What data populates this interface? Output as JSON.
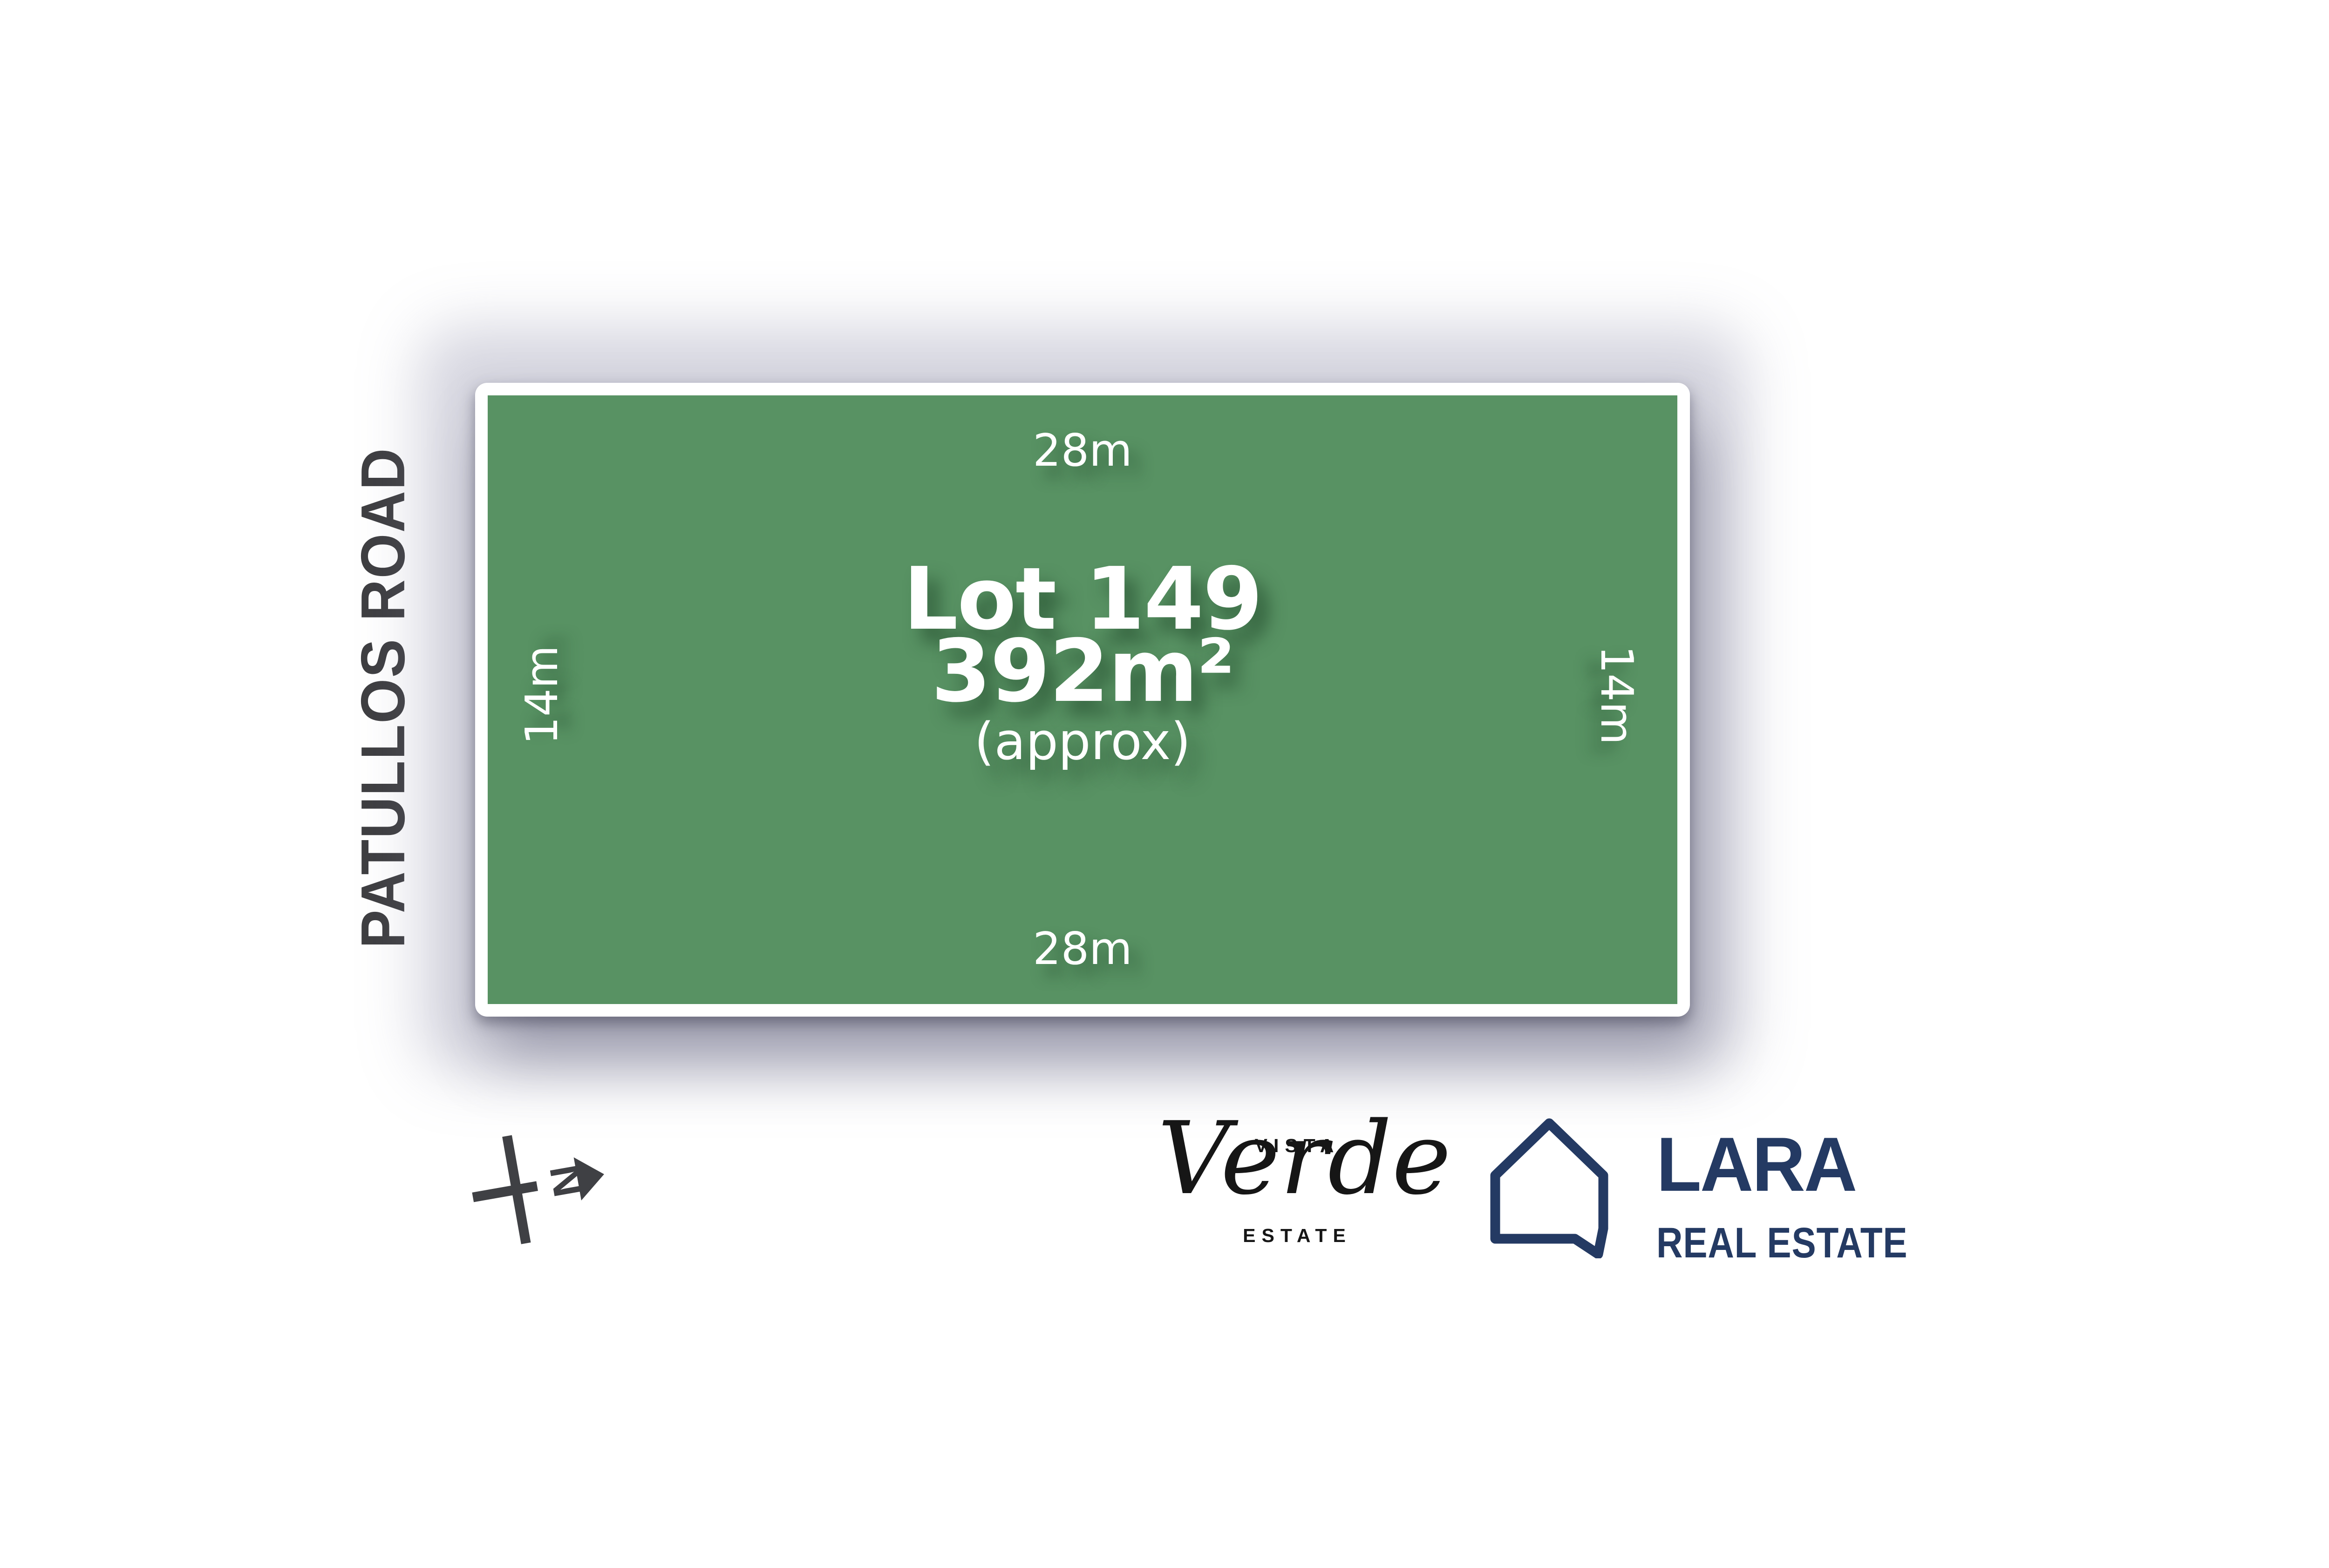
{
  "canvas": {
    "background_color": "#ffffff"
  },
  "street": {
    "label": "PATULLOS ROAD",
    "text_color": "#3e3e41"
  },
  "lot": {
    "title": "Lot 149",
    "area": "392m²",
    "area_note": "(approx)",
    "fill_color": "#589263",
    "border_color": "#ffffff",
    "text_color": "#ffffff",
    "dimensions": {
      "top": "28m",
      "right": "14m",
      "bottom": "28m",
      "left": "14m"
    }
  },
  "north_indicator": {
    "letter": "N",
    "color": "#3f4044"
  },
  "estate_logo": {
    "word_top": "VISTA",
    "word_script": "Verde",
    "word_bottom": "ESTATE",
    "text_color": "#161616"
  },
  "agency_logo": {
    "name": "LARA",
    "tagline": "REAL ESTATE",
    "brand_color": "#243a63"
  }
}
